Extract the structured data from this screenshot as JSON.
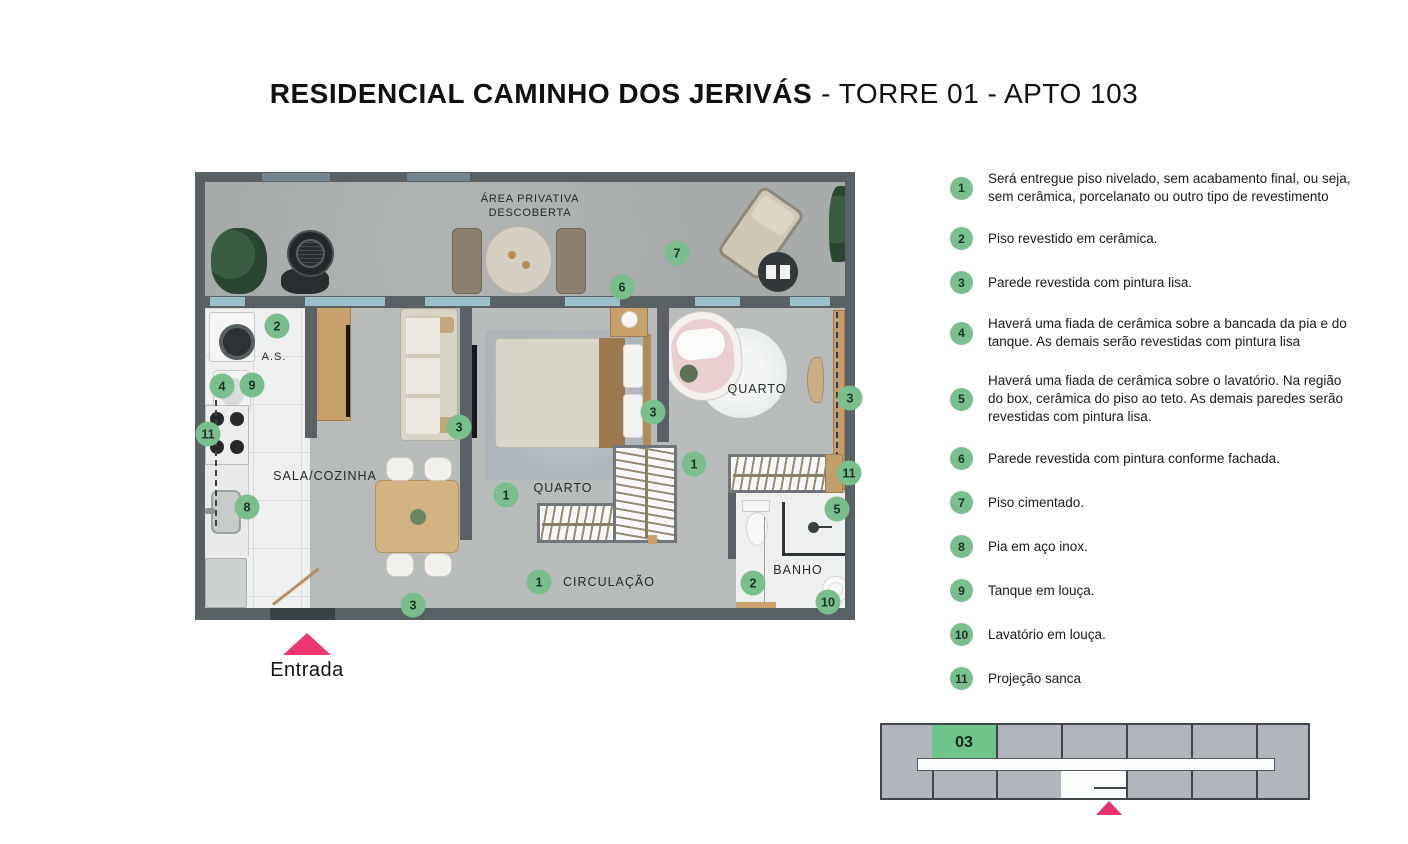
{
  "title": {
    "bold": "RESIDENCIAL CAMINHO DOS JERIVÁS",
    "regular": "- TORRE 01 - APTO 103"
  },
  "plan": {
    "labels": {
      "area_privativa_line1": "ÁREA PRIVATIVA",
      "area_privativa_line2": "DESCOBERTA",
      "service": "A.S.",
      "living": "SALA/COZINHA",
      "bedroom1": "QUARTO",
      "bedroom2": "QUARTO",
      "hall": "CIRCULAÇÃO",
      "bath": "BANHO"
    },
    "entrance_label": "Entrada",
    "badges": [
      {
        "n": "7",
        "x": 482,
        "y": 81
      },
      {
        "n": "6",
        "x": 427,
        "y": 115
      },
      {
        "n": "2",
        "x": 82,
        "y": 154
      },
      {
        "n": "4",
        "x": 27,
        "y": 214
      },
      {
        "n": "9",
        "x": 57,
        "y": 213
      },
      {
        "n": "11",
        "x": 13,
        "y": 262
      },
      {
        "n": "8",
        "x": 52,
        "y": 335
      },
      {
        "n": "3",
        "x": 264,
        "y": 255
      },
      {
        "n": "1",
        "x": 311,
        "y": 323
      },
      {
        "n": "3",
        "x": 458,
        "y": 240
      },
      {
        "n": "1",
        "x": 499,
        "y": 292
      },
      {
        "n": "3",
        "x": 655,
        "y": 226
      },
      {
        "n": "11",
        "x": 654,
        "y": 301
      },
      {
        "n": "5",
        "x": 642,
        "y": 337
      },
      {
        "n": "2",
        "x": 558,
        "y": 411
      },
      {
        "n": "10",
        "x": 633,
        "y": 430
      },
      {
        "n": "1",
        "x": 344,
        "y": 410
      },
      {
        "n": "3",
        "x": 218,
        "y": 433
      }
    ]
  },
  "legend": {
    "items": [
      {
        "num": "1",
        "text": "Será entregue piso nivelado, sem acabamento final, ou seja, sem cerâmica, porcelanato ou outro tipo de revestimento"
      },
      {
        "num": "2",
        "text": "Piso revestido em cerâmica."
      },
      {
        "num": "3",
        "text": "Parede revestida com pintura lisa."
      },
      {
        "num": "4",
        "text": "Haverá uma fiada de cerâmica sobre a bancada da pia e do tanque. As demais serão revestidas com pintura lisa"
      },
      {
        "num": "5",
        "text": "Haverá uma fiada de cerâmica sobre o lavatório. Na região do box, cerâmica do piso ao teto. As demais paredes serão revestidas com pintura lisa."
      },
      {
        "num": "6",
        "text": "Parede revestida com pintura conforme fachada."
      },
      {
        "num": "7",
        "text": "Piso cimentado."
      },
      {
        "num": "8",
        "text": "Pia em aço inox."
      },
      {
        "num": "9",
        "text": "Tanque em louça."
      },
      {
        "num": "10",
        "text": "Lavatório em louça."
      },
      {
        "num": "11",
        "text": "Projeção sanca"
      }
    ]
  },
  "keyplan": {
    "unit_label": "03"
  },
  "colors": {
    "badge_green": "#79bf8d",
    "keyplan_green": "#6ec48b",
    "pink": "#e8386f",
    "wall_gray": "#5a6164"
  }
}
